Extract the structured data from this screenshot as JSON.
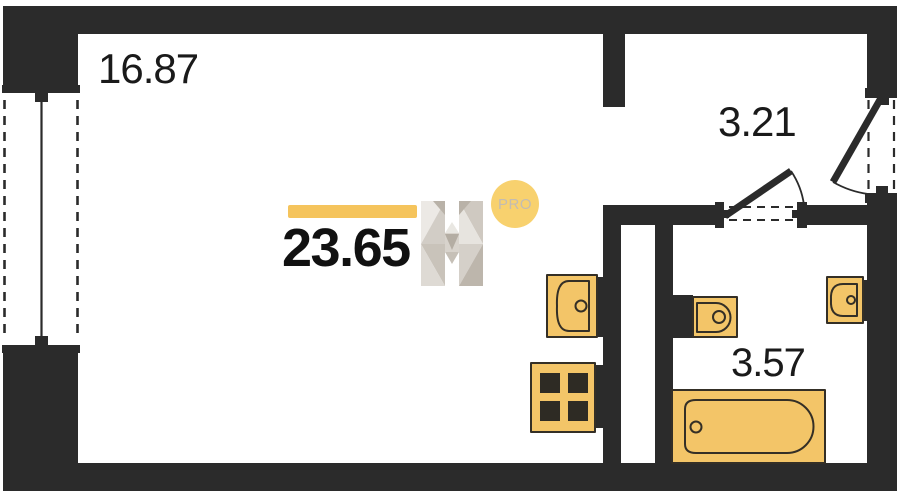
{
  "plan": {
    "rooms": [
      {
        "id": "living-room",
        "area": "16.87"
      },
      {
        "id": "hallway",
        "area": "3.21"
      },
      {
        "id": "bathroom",
        "area": "3.57"
      }
    ],
    "total_area": "23.65",
    "badge": "PRO",
    "fixtures": [
      "kitchen-sink",
      "stove",
      "toilet",
      "washbasin",
      "bathtub"
    ],
    "colors": {
      "wall": "#2b2b2b",
      "fixture_fill": "#f3c568",
      "fixture_stroke": "#342f26",
      "accent_bar": "#f5c45c",
      "badge_circle": "#f8d16e",
      "badge_text": "#c3bcb2"
    }
  }
}
